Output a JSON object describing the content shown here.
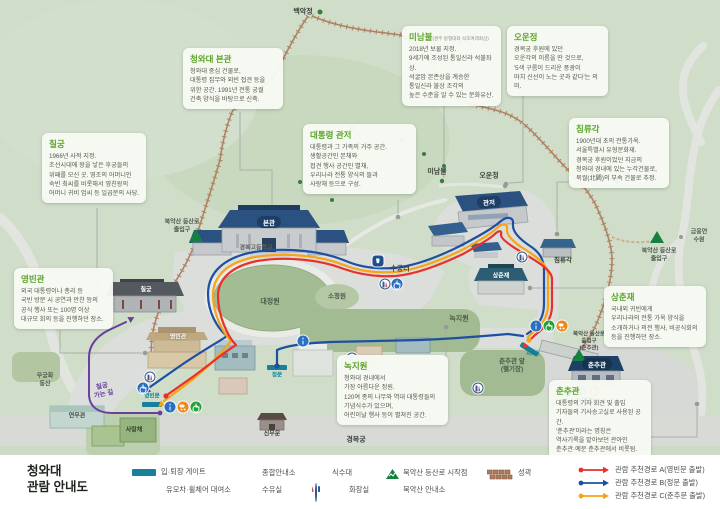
{
  "legend_title": {
    "line1": "청와대",
    "line2": "관람 안내도"
  },
  "info_boxes": {
    "bongwan": {
      "title": "청와대 본관",
      "body": "청와대 중심 건물로,\n대통령 집무와 외빈 접견 등을\n위한 공간. 1991년 전통 궁궐\n건축 양식을 바탕으로 신축."
    },
    "chilgung": {
      "title": "칠궁",
      "body": "1966년 사적 지정.\n조선시대에 왕을 낳은 후궁들의\n위패를 모신 곳. 영조의 어머니인\n숙빈 최씨를 비롯해서 영친왕의\n어머니 귀비 엄씨 등 일곱분의 사당."
    },
    "minambul": {
      "title": "미남불",
      "subtitle": "(경주 방형대좌 석조여래좌상)",
      "body": "2018년 보물 지정.\n9세기에 조성된 통일신라 석불좌상.\n석굴암 본존상을 계승한\n통일신라 불상 조각의\n높은 수준을 알 수 있는 문화유산."
    },
    "ounjeong": {
      "title": "오운정",
      "body": "경복궁 후원에 있던\n오운각의 이름을 딴 것으로,\n'5색 구름이 드리운 풍광이\n마치 신선이 노는 곳과 같다'는 의미."
    },
    "gwanjeo": {
      "title": "대통령 관저",
      "body": "대통령과 그 가족의 거주 공간.\n생활공간인 본채와\n접견 행사 공간인 별채,\n우리나라 전통 양식의 뜰과\n사랑채 등으로 구성."
    },
    "chimnyugak": {
      "title": "침류각",
      "body": "1900년대 초의 전통가옥.\n서울특별시 유형문화재.\n경복궁 후원이었던 지금의\n청와대 경내에 있는 누각건물로,\n북궐(北闕)의 부속 건물로 추정."
    },
    "yeongbingwan": {
      "title": "영빈관",
      "body": "외국 대통령이나 총리 등\n국빈 방문 시 공연과 만찬 등의\n공식 행사 또는 100명 이상\n대규모 회의 등을 진행하던 장소."
    },
    "nokjiwon": {
      "title": "녹지원",
      "body": "청와대 경내에서\n가장 아름다운 정원.\n120여 종의 나무와 역대 대통령들의\n기념식수가 있으며,\n어린이날 행사 등이 펼쳐진 공간."
    },
    "sangchunjae": {
      "title": "상춘재",
      "body": "국내외 귀빈에게\n우리나라의 전통 가옥 양식을\n소개하거나 의전 행사, 비공식회의\n등을 진행하던 장소."
    },
    "chunchugwan": {
      "title": "춘추관",
      "body": "대통령의 기자 회견 및 출입\n기자들의 기사송고실로 사용된 공간.\n'춘추관'이라는 명칭은\n역사기록을 맡아보던 관아인\n춘추관·예문 춘추관에서 비롯됨."
    }
  },
  "buildings": {
    "bongwan": "본관",
    "gwanjeo": "관저",
    "chilgung": "칠궁",
    "yeongbingwan": "영빈관",
    "sangchunjae": "상춘재",
    "chunchugwan": "춘추관",
    "yeonmugwan": "연무관",
    "sarangchae": "사랑채",
    "sinmumun": "신무문",
    "chimnyugak": "침류각"
  },
  "map_labels": {
    "baekakjeong": "백악정",
    "minambul": "미남불",
    "ounjeong": "오운정",
    "sugungteo": "수궁터",
    "daejeongwon": "대정원",
    "sojeongwon": "소정원",
    "nokjiwon": "녹지원",
    "helipad": "춘추관 앞\n(헬기장)",
    "mugunghwa": "무궁화\n동산",
    "gyeongbokgung": "경복궁",
    "gyeongbokgo": "경복고등학교",
    "geumyung": "금융연수원",
    "chilgung_road": "칠궁\n가는 길",
    "trail_west": "북악산 등산로\n출입구",
    "trail_east": "북악산 등산로\n출입구",
    "trail_chunchu": "북악산 등산로\n출입구\n(춘추관)"
  },
  "gates": {
    "yeongbinmun": "영빈문",
    "jeongmun": "정문",
    "chunchumun": "춘추문",
    "sihwamun": "시화문"
  },
  "legend": {
    "items": {
      "gate": {
        "icon": "entry-exit-gate-bar",
        "label": "입·퇴장 게이트"
      },
      "rental": {
        "icon": "stroller-wheelchair-icons",
        "label": "유모차·휠체어 대여소"
      },
      "info": {
        "icon": "information-icon",
        "label": "종합안내소"
      },
      "nursing": {
        "icon": "nursing-room-icon",
        "label": "수유실"
      },
      "water": {
        "icon": "drinking-fountain-icon",
        "label": "식수대"
      },
      "toilet": {
        "icon": "restroom-icons",
        "label": "화장실"
      },
      "trailhead": {
        "icon": "mountain-trailhead-icon",
        "label": "북악산 등산로 시작점"
      },
      "trailinfo": {
        "icon": "mountain-info-icon",
        "label": "북악산 안내소"
      },
      "wall": {
        "icon": "fortress-wall-icon",
        "label": "성곽"
      }
    },
    "routes": {
      "a": {
        "color": "#e8312a",
        "label": "관람 추천경로 A(영빈문 출발)"
      },
      "b": {
        "color": "#1d50a2",
        "label": "관람 추천경로 B(정문 출발)"
      },
      "c": {
        "color": "#f6a418",
        "label": "관람 추천경로 C(춘추문 출발)"
      }
    }
  },
  "colors": {
    "background_green": "#cfddc9",
    "lawn_green": "#a3bc94",
    "plaza_gray": "#dbdeda",
    "route_a_red": "#e8312a",
    "route_b_blue": "#1d50a2",
    "route_c_orange": "#f6a418",
    "chilgung_path_purple": "#6a3f9e",
    "trail_brown": "#b08263",
    "gate_teal": "#1a7f9b",
    "box_title_green": "#5ca32a",
    "roof_navy": "#2a5180"
  }
}
